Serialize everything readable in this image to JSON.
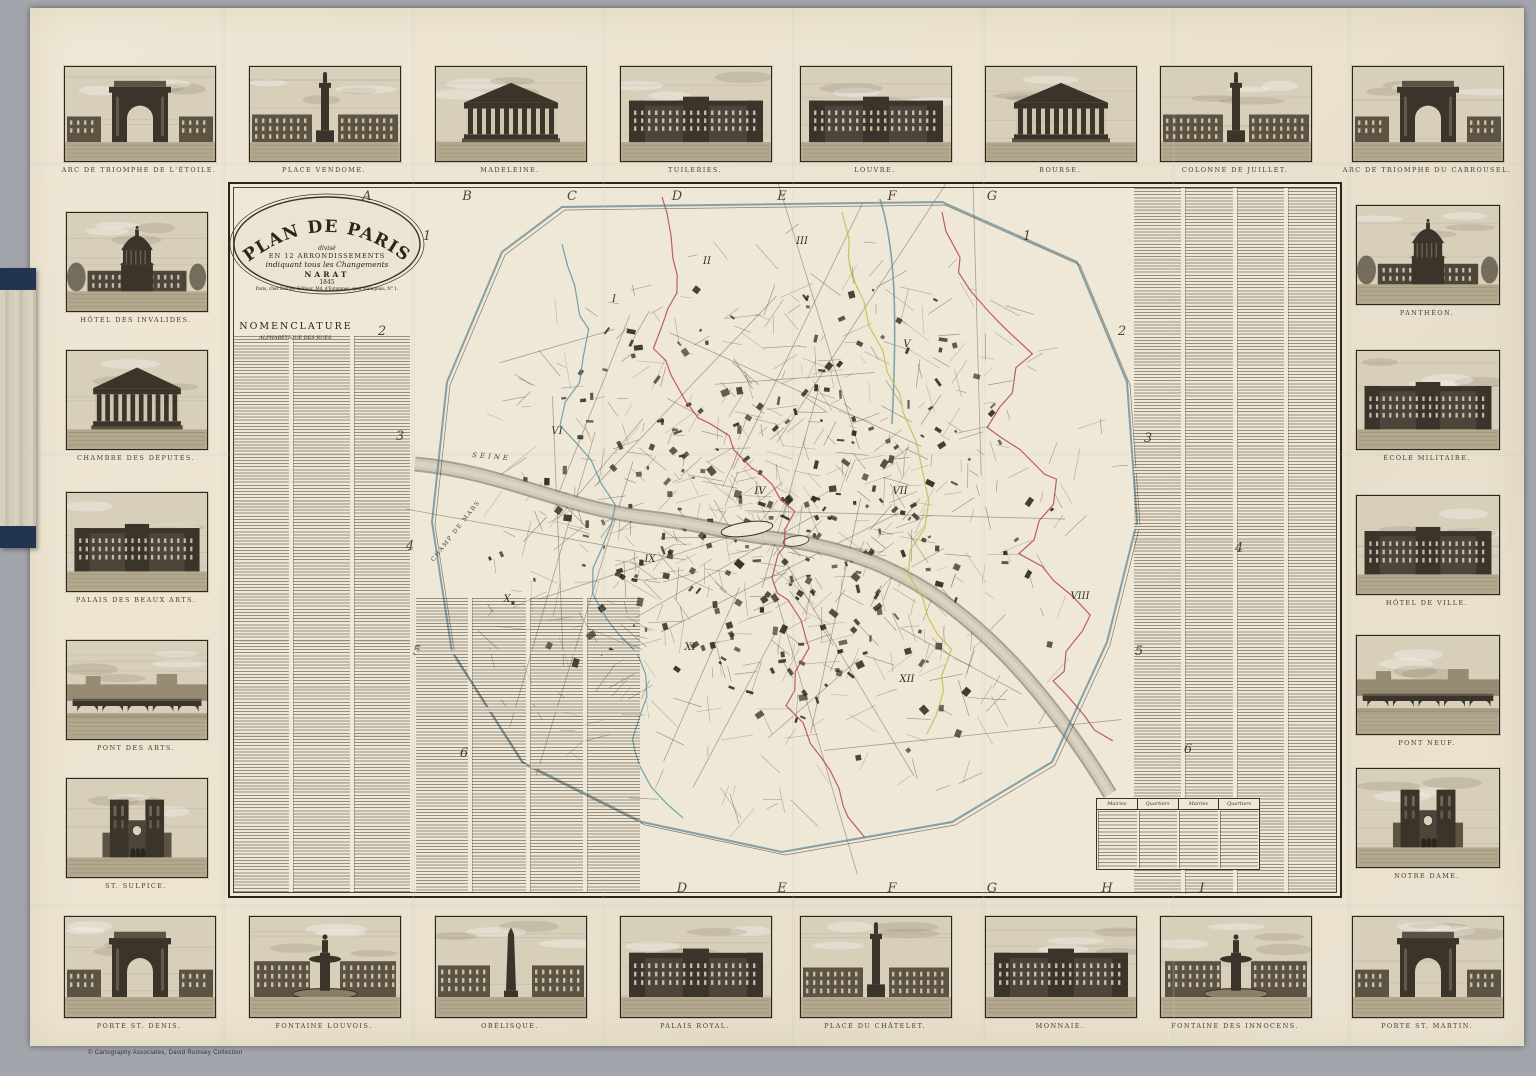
{
  "page": {
    "background": "#a2a6ac",
    "sheet_color": "#ece4d1",
    "ink_color": "#3a332b",
    "attribution": "© Cartography Associates, David Rumsey Collection"
  },
  "cartouche": {
    "title": "PLAN DE PARIS",
    "line_divise": "divisé",
    "line_arrondissements": "EN 12 ARRONDISSEMENTS",
    "line_indiquant": "indiquant tous les Changements",
    "line_narat": "NARAT",
    "line_year": "1845",
    "line_publisher": "Paris, chez Danlos, Éditeur, Md. d'Estampes, quai Malaquais, N° 1."
  },
  "nomenclature": {
    "title": "NOMENCLATURE",
    "subtitle": "ALPHABÉTIQUE DES RUES."
  },
  "grid": {
    "top_letters": [
      "A",
      "B",
      "C",
      "D",
      "E",
      "F",
      "G"
    ],
    "bottom_letters": [
      "D",
      "E",
      "F",
      "G",
      "H",
      "I"
    ],
    "left_numbers": [
      "1",
      "2",
      "3",
      "4",
      "5",
      "6"
    ],
    "right_numbers": [
      "1",
      "2",
      "3",
      "4",
      "5",
      "6"
    ]
  },
  "map_labels": {
    "river": "SEINE",
    "champ_de_mars": "CHAMP DE MARS",
    "arrondissements": [
      "I",
      "II",
      "III",
      "IV",
      "V",
      "VI",
      "VII",
      "VIII",
      "IX",
      "X",
      "XI",
      "XII"
    ]
  },
  "legend_table": {
    "headers": [
      "Mairies",
      "Quartiers",
      "Mairies",
      "Quartiers"
    ]
  },
  "boundary_colors": {
    "red": "#b0454d",
    "blue": "#5d93a3",
    "yellow": "#c9b94e"
  },
  "vignettes": {
    "top": [
      {
        "caption": "ARC DE TRIOMPHE DE L'ÉTOILE.",
        "kind": "arch"
      },
      {
        "caption": "PLACE VENDOME.",
        "kind": "column"
      },
      {
        "caption": "MADELEINE.",
        "kind": "temple"
      },
      {
        "caption": "TUILERIES.",
        "kind": "palace"
      },
      {
        "caption": "LOUVRE.",
        "kind": "palace"
      },
      {
        "caption": "BOURSE.",
        "kind": "temple"
      },
      {
        "caption": "COLONNE DE JUILLET.",
        "kind": "column"
      },
      {
        "caption": "ARC DE TRIOMPHE DU CARROUSEL.",
        "kind": "arch"
      }
    ],
    "left": [
      {
        "caption": "HÔTEL DES INVALIDES.",
        "kind": "dome"
      },
      {
        "caption": "CHAMBRE DES DÉPUTÉS.",
        "kind": "temple"
      },
      {
        "caption": "PALAIS DES BEAUX ARTS.",
        "kind": "palace"
      },
      {
        "caption": "PONT DES ARTS.",
        "kind": "bridge"
      },
      {
        "caption": "ST. SULPICE.",
        "kind": "towers"
      }
    ],
    "right": [
      {
        "caption": "PANTHÉON.",
        "kind": "dome"
      },
      {
        "caption": "ÉCOLE MILITAIRE.",
        "kind": "palace"
      },
      {
        "caption": "HÔTEL DE VILLE.",
        "kind": "palace"
      },
      {
        "caption": "PONT NEUF.",
        "kind": "bridge"
      },
      {
        "caption": "NOTRE DAME.",
        "kind": "towers"
      }
    ],
    "bottom": [
      {
        "caption": "PORTE ST. DENIS.",
        "kind": "arch"
      },
      {
        "caption": "FONTAINE LOUVOIS.",
        "kind": "fountain"
      },
      {
        "caption": "OBÉLISQUE.",
        "kind": "obelisk"
      },
      {
        "caption": "PALAIS ROYAL.",
        "kind": "palace"
      },
      {
        "caption": "PLACE DU CHÂTELET.",
        "kind": "column"
      },
      {
        "caption": "MONNAIE.",
        "kind": "palace"
      },
      {
        "caption": "FONTAINE DES INNOCENS.",
        "kind": "fountain"
      },
      {
        "caption": "PORTE ST. MARTIN.",
        "kind": "arch"
      }
    ]
  }
}
